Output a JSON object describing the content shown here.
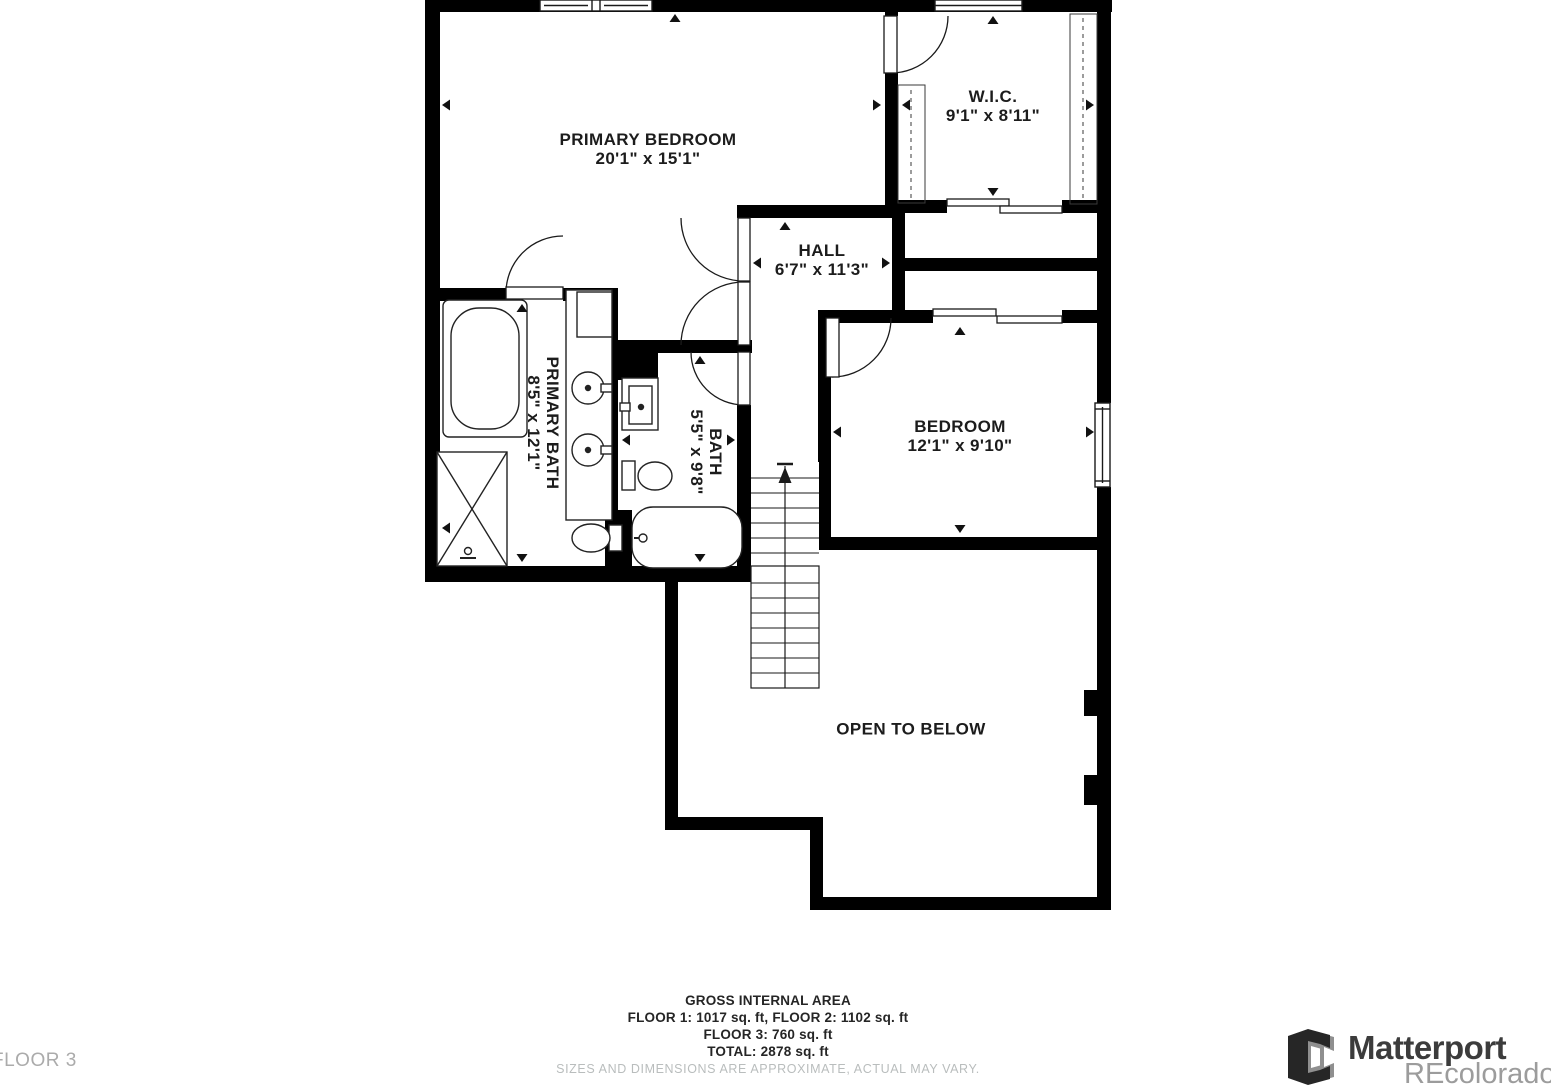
{
  "floorplan": {
    "rooms": [
      {
        "id": "primary-bedroom",
        "name": "PRIMARY BEDROOM",
        "dims": "20'1\" x 15'1\""
      },
      {
        "id": "wic",
        "name": "W.I.C.",
        "dims": "9'1\" x 8'11\""
      },
      {
        "id": "hall",
        "name": "HALL",
        "dims": "6'7\" x 11'3\""
      },
      {
        "id": "primary-bath",
        "name": "PRIMARY BATH",
        "dims": "8'5\" x 12'1\""
      },
      {
        "id": "bath",
        "name": "BATH",
        "dims": "5'5\" x 9'8\""
      },
      {
        "id": "bedroom",
        "name": "BEDROOM",
        "dims": "12'1\" x 9'10\""
      },
      {
        "id": "open-to-below",
        "name": "OPEN TO BELOW",
        "dims": ""
      }
    ]
  },
  "footer": {
    "title": "GROSS INTERNAL AREA",
    "line1": "FLOOR 1: 1017 sq. ft, FLOOR 2: 1102 sq. ft",
    "line2": "FLOOR 3: 760 sq. ft",
    "line3": "TOTAL: 2878 sq. ft",
    "disclaimer": "SIZES AND DIMENSIONS ARE APPROXIMATE, ACTUAL MAY VARY."
  },
  "floor_label": "FLOOR 3",
  "branding": {
    "name": "Matterport",
    "watermark": "REcolorado"
  },
  "colors": {
    "wall": "#000000",
    "line": "#1a1a1a",
    "label_text": "#1c1c1c",
    "muted_text": "#b9bdbd",
    "logo_dark": "#262626",
    "logo_gray": "#8f8f8f"
  }
}
